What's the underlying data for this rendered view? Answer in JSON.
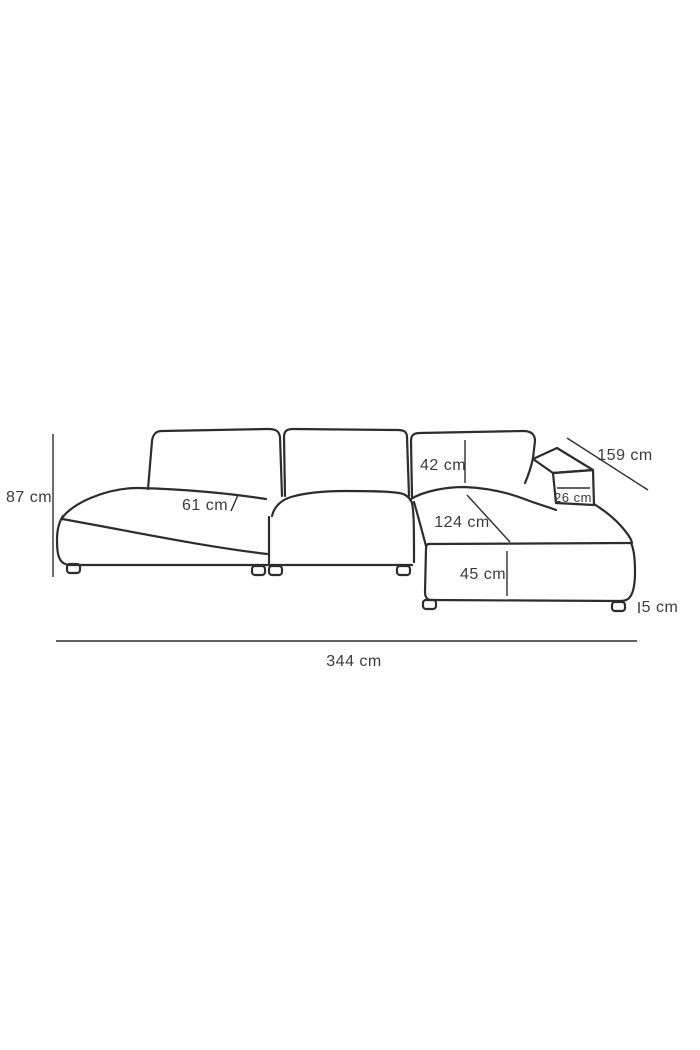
{
  "diagram": {
    "subject": "corner-sofa-dimension-drawing",
    "unit": "cm",
    "colors": {
      "background": "#ffffff",
      "line": "#2d2d2d",
      "text": "#3c3c3c"
    },
    "dimensions": {
      "overall_height": {
        "value": 87,
        "label": "87 cm"
      },
      "seat_depth": {
        "value": 61,
        "label": "61 cm"
      },
      "back_cushion_height": {
        "value": 42,
        "label": "42 cm"
      },
      "chaise_side_depth": {
        "value": 159,
        "label": "159 cm"
      },
      "armrest_width": {
        "value": 26,
        "label": "26 cm"
      },
      "chaise_length": {
        "value": 124,
        "label": "124 cm"
      },
      "seat_height": {
        "value": 45,
        "label": "45 cm"
      },
      "leg_height": {
        "value": 5,
        "label": "5 cm"
      },
      "overall_width": {
        "value": 344,
        "label": "344 cm"
      }
    }
  }
}
